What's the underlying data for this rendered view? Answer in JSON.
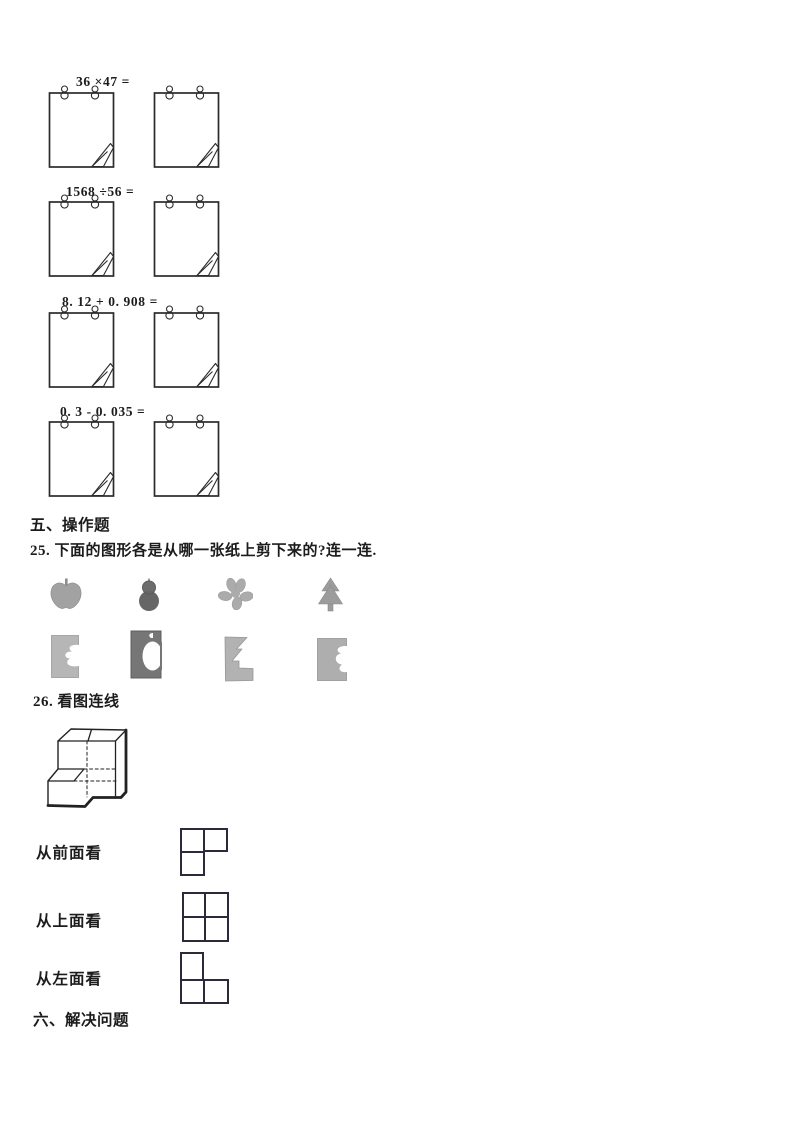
{
  "calc_problems": [
    {
      "label": "36 ×47 ="
    },
    {
      "label": "1568 ÷56 ="
    },
    {
      "label": "8. 12 + 0. 908 ="
    },
    {
      "label": "0. 3 - 0. 035 ="
    }
  ],
  "section_five": {
    "title": "五、操作题"
  },
  "q25": {
    "text": "25. 下面的图形各是从哪一张纸上剪下来的?连一连.",
    "shapes": [
      "apple",
      "gourd",
      "flower",
      "pine-tree"
    ],
    "papers": [
      "paper-with-flower-cutout",
      "paper-with-gourd-cutout",
      "paper-with-tree-cutout",
      "paper-with-apple-cutout"
    ]
  },
  "q26": {
    "text": "26. 看图连线",
    "views": [
      {
        "label": "从前面看"
      },
      {
        "label": "从上面看"
      },
      {
        "label": "从左面看"
      }
    ]
  },
  "section_six": {
    "title": "六、解决问题"
  },
  "colors": {
    "ink": "#1c1c1c",
    "shape_gray": "#9c9c9c",
    "dark_gray": "#636363",
    "paper_gray": "#b4b4b4"
  }
}
